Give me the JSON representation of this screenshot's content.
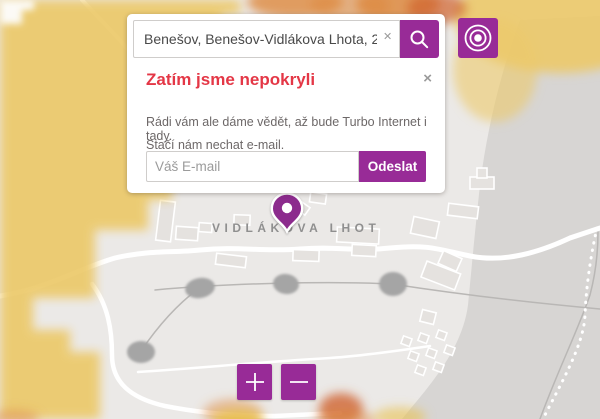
{
  "search": {
    "query": "Benešov, Benešov-Vidlákova Lhota, 2560",
    "clear_icon": "✕",
    "search_icon": "magnifier"
  },
  "popup": {
    "title": "Zatím jsme nepokryli",
    "close_icon": "×",
    "body_line1": "Rádi vám ale dáme vědět, až bude Turbo Internet i tady.",
    "body_line2": "Stačí nám nechat e-mail.",
    "email_placeholder": "Váš E-mail",
    "submit_label": "Odeslat"
  },
  "map": {
    "place_label": "VIDLÁKOVA LHOT",
    "marker": "map-pin",
    "locate_icon": "target-concentric-circles",
    "zoom_in_glyph": "+",
    "zoom_out_glyph": "−"
  },
  "colors": {
    "accent": "#982b97",
    "pin": "#8c2b8d",
    "red_title": "#e43746",
    "map_bg": "#ebe9e7",
    "forest": "#d7d5d3",
    "building": "#e5e2df",
    "pond": "#a5a5a5",
    "label_gray": "#8f8f8f",
    "text_gray": "#6d6868",
    "yellow": "#ecc96a",
    "orange": "#dd8a3f",
    "deep_orange": "#d0622f"
  }
}
